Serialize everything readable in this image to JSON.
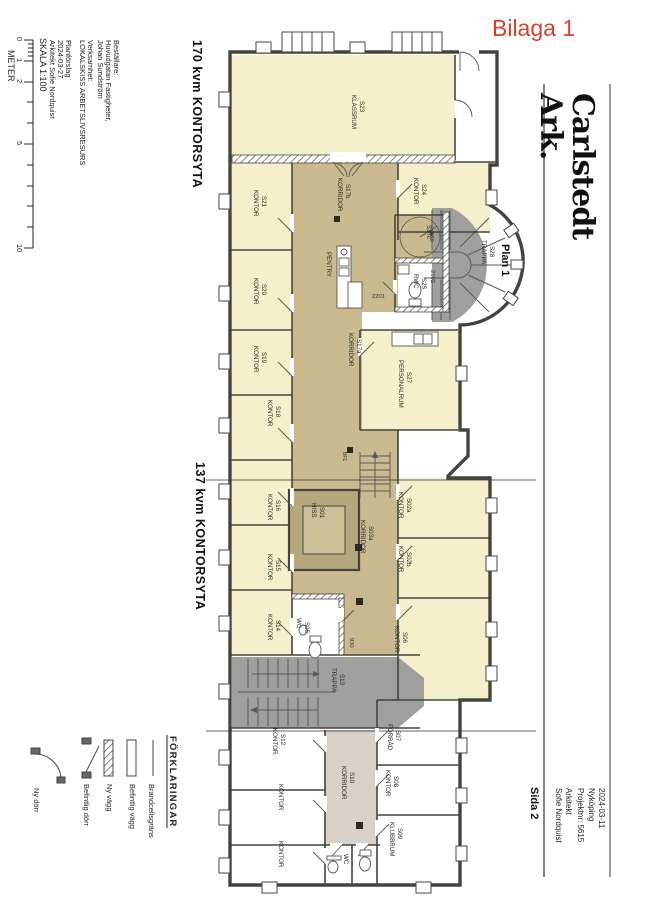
{
  "annotation": {
    "label": "Bilaga 1",
    "color": "#d8402e"
  },
  "title_block": {
    "logo_line1": "Carlstedt",
    "logo_line2": "Ark.",
    "plan_label": "Plan 1",
    "page_label": "Sida 2",
    "info_lines": [
      "2024-03-11",
      "Nyköping",
      "Projektnr: 5615",
      "Arkitekt",
      "Sofie Nordquist"
    ]
  },
  "project_info": {
    "block1": [
      "Beställare:",
      "Huvudgatan Fastigheter,",
      "Johan Sundström",
      "Verksamhet:",
      "LOKALSKISS ARBETSLIVSRESURS"
    ],
    "block2": [
      "Planförslag",
      "2024-03-27",
      "Arkitekt Sofie Nordquist"
    ]
  },
  "scale": {
    "label": "SKALA 1:100",
    "unit": "METER",
    "ticks": [
      "0",
      "1",
      "2",
      "5",
      "10"
    ]
  },
  "area_labels": {
    "top": "170 kvm KONTORSYTA",
    "middle": "137 kvm KONTORSYTA"
  },
  "legend": {
    "title": "FÖRKLARINGAR",
    "items": [
      {
        "symbol": "fire-boundary-line",
        "label": "Brandcellsgräns"
      },
      {
        "symbol": "existing-wall-rect",
        "label": "Befintlig vägg"
      },
      {
        "symbol": "new-wall-hatched-rect",
        "label": "Ny vägg"
      },
      {
        "symbol": "existing-door-leaf",
        "label": "Befintlig dörr"
      },
      {
        "symbol": "new-door-arc",
        "label": "Ny dörr"
      }
    ]
  },
  "plan": {
    "rooms": [
      {
        "id": "S23",
        "name": "KLASSRUM"
      },
      {
        "id": "S21",
        "name": "KONTOR"
      },
      {
        "id": "S17b",
        "name": "KORRIDOR"
      },
      {
        "id": "S24",
        "name": "KONTOR"
      },
      {
        "id": "S28",
        "name": "TRAPPA"
      },
      {
        "id": "S20",
        "name": "KONTOR"
      },
      {
        "id": "",
        "name": "PENTRY"
      },
      {
        "id": "S17c",
        "name": ""
      },
      {
        "id": "S25",
        "name": "RWC"
      },
      {
        "id": "S19",
        "name": "KONTOR"
      },
      {
        "id": "S17a",
        "name": "KORRIDOR"
      },
      {
        "id": "S27",
        "name": "PERSONALRUM"
      },
      {
        "id": "S18",
        "name": "KONTOR"
      },
      {
        "id": "S16",
        "name": "KONTOR"
      },
      {
        "id": "S01",
        "name": "HISS"
      },
      {
        "id": "S03a",
        "name": "KORRIDOR"
      },
      {
        "id": "S02a",
        "name": "KONTOR"
      },
      {
        "id": "S15",
        "name": "KONTOR"
      },
      {
        "id": "S02b",
        "name": "KONTOR"
      },
      {
        "id": "S14",
        "name": "KONTOR"
      },
      {
        "id": "S05",
        "name": "WC"
      },
      {
        "id": "S06",
        "name": "KONTOR"
      },
      {
        "id": "S13",
        "name": "TRAPPA"
      },
      {
        "id": "S07",
        "name": "FÖRRÅD"
      },
      {
        "id": "S12",
        "name": "KONTOR"
      },
      {
        "id": "",
        "name": "KONTOR"
      },
      {
        "id": "",
        "name": "KONTOR"
      },
      {
        "id": "S10",
        "name": "KORRIDOR"
      },
      {
        "id": "S08",
        "name": "KONTOR"
      },
      {
        "id": "S09",
        "name": "KLUBBRUM"
      },
      {
        "id": "",
        "name": "WC"
      }
    ],
    "measurements": {
      "m560": "560",
      "m2102": "2102",
      "m2201": "2201",
      "m930": "930",
      "bf": "BF1"
    },
    "colors": {
      "office_yellow": "#f6efcc",
      "corridor_tan": "#cab98f",
      "elevator_tan": "#b6a77d",
      "stair_grey": "#9f9f9d",
      "lower_corridor_pink": "#d9d0c9",
      "wall": "#44443c",
      "annotation_red": "#d8402e"
    }
  }
}
